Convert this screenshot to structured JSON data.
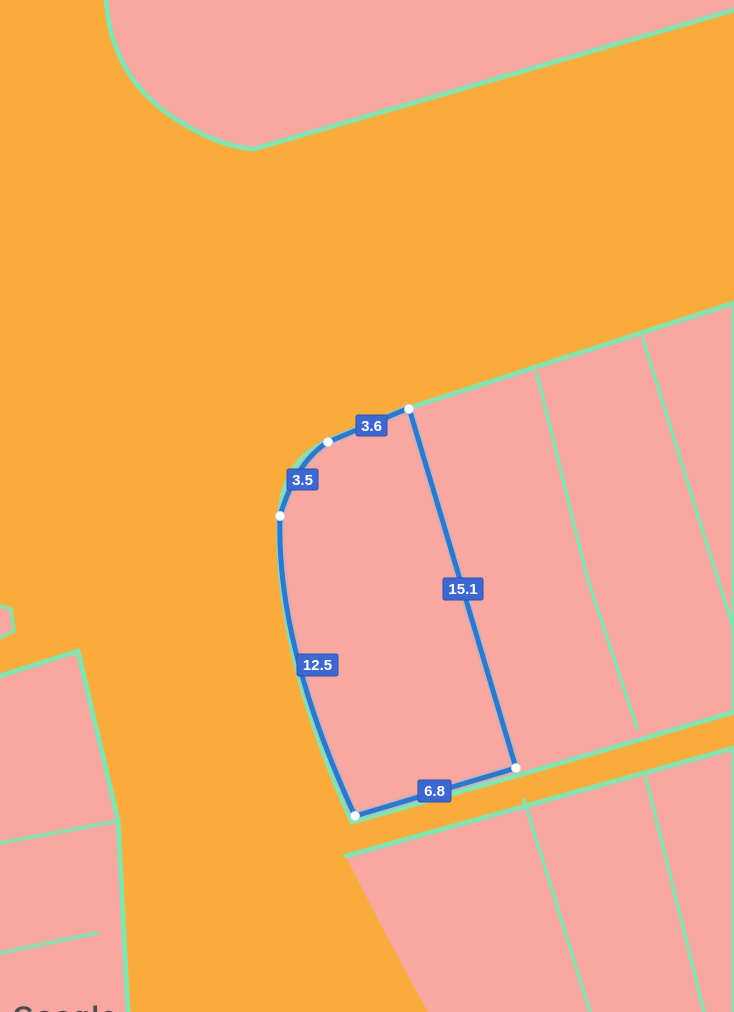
{
  "map": {
    "watermark": "Google",
    "measurements": [
      {
        "name": "segment-top",
        "value": "3.6"
      },
      {
        "name": "segment-upper-left",
        "value": "3.5"
      },
      {
        "name": "segment-right",
        "value": "15.1"
      },
      {
        "name": "segment-left",
        "value": "12.5"
      },
      {
        "name": "segment-bottom",
        "value": "6.8"
      }
    ],
    "colors": {
      "road_orange": "#F9AC3B",
      "parcel_pink": "#F9A7A1",
      "boundary_teal": "#7FE6B2",
      "measure_blue": "#2E78CC",
      "label_bg": "#3D68CF",
      "label_text": "#FFFFFF",
      "vertex_white": "#FFFFFF",
      "watermark_gray": "#4D4D4D"
    }
  }
}
